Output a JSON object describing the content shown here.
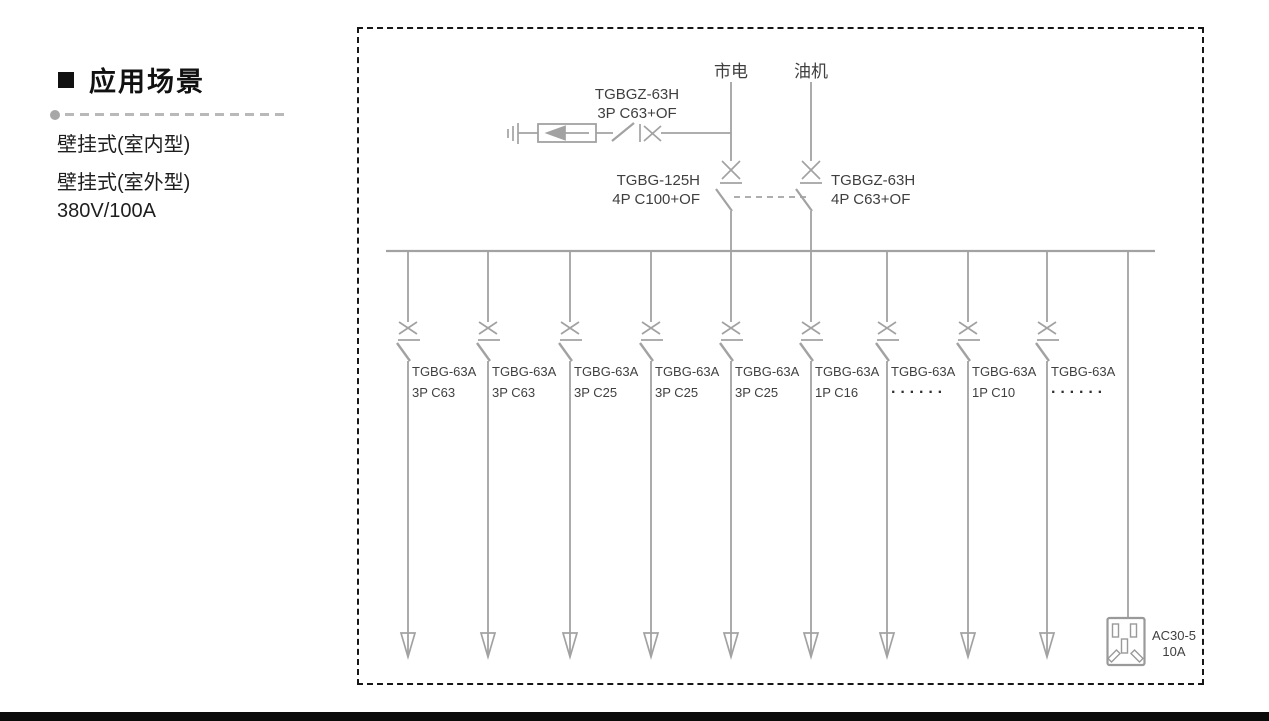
{
  "left_panel": {
    "heading": "应用场景",
    "items": [
      "壁挂式(室内型)",
      "壁挂式(室外型)",
      "380V/100A"
    ]
  },
  "diagram": {
    "source_mains": "市电",
    "source_generator": "油机",
    "surge_branch": {
      "model": "TGBGZ-63H",
      "spec": "3P C63+OF"
    },
    "ats_mains": {
      "model": "TGBG-125H",
      "spec": "4P C100+OF"
    },
    "ats_generator": {
      "model": "TGBGZ-63H",
      "spec": "4P C63+OF"
    },
    "feeders": [
      {
        "model": "TGBG-63A",
        "spec": "3P C63"
      },
      {
        "model": "TGBG-63A",
        "spec": "3P C63"
      },
      {
        "model": "TGBG-63A",
        "spec": "3P C25"
      },
      {
        "model": "TGBG-63A",
        "spec": "3P C25"
      },
      {
        "model": "TGBG-63A",
        "spec": "3P C25"
      },
      {
        "model": "TGBG-63A",
        "spec": "1P C16"
      },
      {
        "model": "TGBG-63A",
        "spec": "······"
      },
      {
        "model": "TGBG-63A",
        "spec": "1P C10"
      },
      {
        "model": "TGBG-63A",
        "spec": "······"
      }
    ],
    "socket": {
      "model": "AC30-5",
      "rating": "10A"
    }
  },
  "colors": {
    "line": "#a2a2a2",
    "diagram_text": "#3f3f3f",
    "border": "#161616"
  }
}
